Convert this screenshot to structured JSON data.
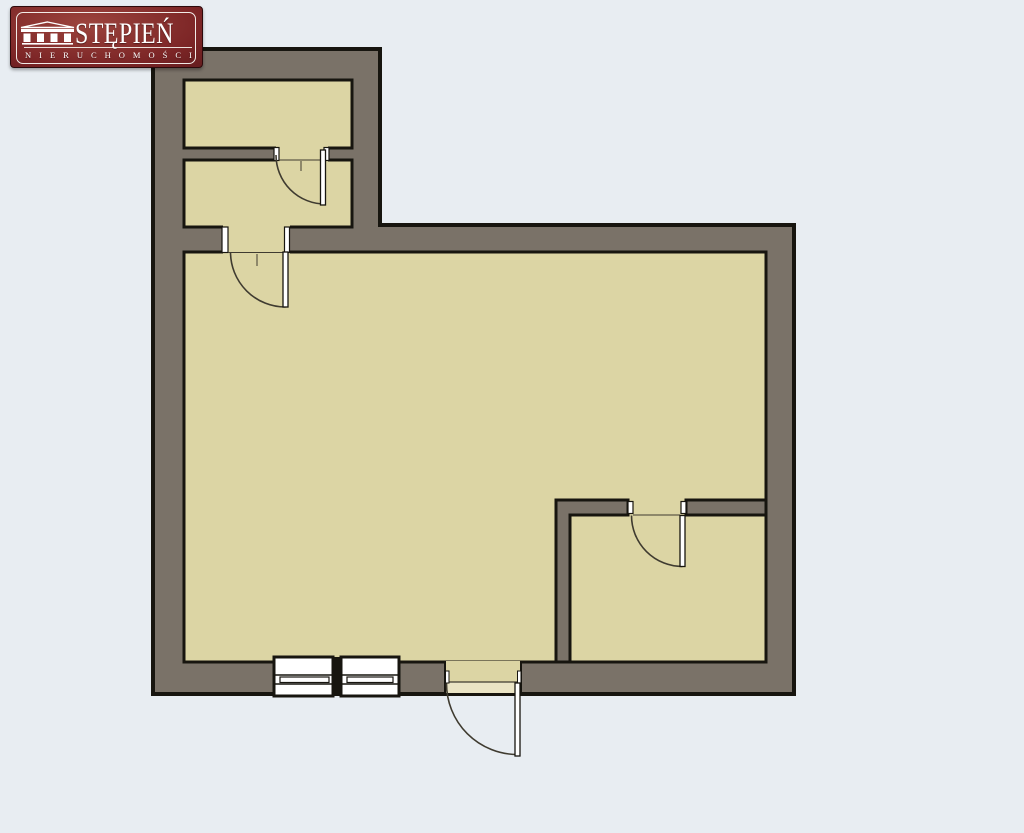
{
  "theme": {
    "background": "#e8edf2",
    "wall": "#7a7268",
    "floor": "#dcd5a4",
    "threshold": "#eae4c5",
    "outline": "#17150f",
    "window": "#ffffff",
    "swing": "#3f3b30",
    "logo_red": "#7c2526",
    "logo_red_light": "#9c443d",
    "logo_red_dark": "#401013",
    "logo_text": "#ffffff",
    "logo_border": "#f8f5f1"
  },
  "logo": {
    "title": "STĘPIEŃ",
    "subtitle": "NIERUCHOMOŚCI",
    "icon": "temple-icon"
  },
  "floorplan": {
    "rooms": [
      "top-small-room-1",
      "top-small-room-2",
      "main-room",
      "bottom-right-room"
    ],
    "door_count": 4,
    "window_count": 2,
    "shapes": [
      {
        "name": "exterior-wall",
        "type": "polygon",
        "points": "153,49 380,49 380,225 794,225 794,694 153,694",
        "fill": "wall",
        "stroke": "outline",
        "sw": 4
      },
      {
        "name": "room-top-1-floor",
        "type": "rect",
        "x": 184,
        "y": 80,
        "w": 168,
        "h": 68,
        "fill": "floor",
        "stroke": "outline",
        "sw": 3
      },
      {
        "name": "room-top-2-floor",
        "type": "rect",
        "x": 184,
        "y": 160,
        "w": 168,
        "h": 67,
        "fill": "floor",
        "stroke": "outline",
        "sw": 3
      },
      {
        "name": "main-room-floor",
        "type": "rect",
        "x": 184,
        "y": 252,
        "w": 582,
        "h": 410,
        "fill": "floor",
        "stroke": "outline",
        "sw": 3
      },
      {
        "name": "door-1-opening",
        "type": "rect",
        "x": 276,
        "y": 146,
        "w": 52,
        "h": 16,
        "fill": "floor"
      },
      {
        "name": "door-2-opening",
        "type": "rect",
        "x": 223,
        "y": 223,
        "w": 67,
        "h": 31,
        "fill": "floor"
      },
      {
        "name": "br-room-wall-left",
        "type": "path",
        "d": "M556,500 L628,500 L628,515 L570,515 L570,662 L556,662 Z",
        "fill": "wall",
        "stroke": "outline",
        "sw": 3
      },
      {
        "name": "br-room-wall-right",
        "type": "rect",
        "x": 686,
        "y": 500,
        "w": 80,
        "h": 15,
        "fill": "wall",
        "stroke": "outline",
        "sw": 3
      },
      {
        "name": "door-1-jamb-left",
        "type": "rect",
        "x": 274,
        "y": 147.5,
        "w": 5,
        "h": 13,
        "fill": "window",
        "stroke": "outline",
        "sw": 1.2
      },
      {
        "name": "door-1-jamb-right",
        "type": "rect",
        "x": 324,
        "y": 147.5,
        "w": 5,
        "h": 13,
        "fill": "window",
        "stroke": "outline",
        "sw": 1.2
      },
      {
        "name": "door-2-jamb-left",
        "type": "rect",
        "x": 222,
        "y": 227,
        "w": 6,
        "h": 25.5,
        "fill": "window",
        "stroke": "outline",
        "sw": 1.2
      },
      {
        "name": "door-2-jamb-right",
        "type": "rect",
        "x": 284.5,
        "y": 227,
        "w": 5,
        "h": 25.5,
        "fill": "window",
        "stroke": "outline",
        "sw": 1.2
      },
      {
        "name": "door-3-jamb-left",
        "type": "rect",
        "x": 628,
        "y": 501.5,
        "w": 5,
        "h": 12,
        "fill": "window",
        "stroke": "outline",
        "sw": 1.2
      },
      {
        "name": "door-3-jamb-right",
        "type": "rect",
        "x": 681,
        "y": 501.5,
        "w": 5,
        "h": 12,
        "fill": "window",
        "stroke": "outline",
        "sw": 1.2
      },
      {
        "name": "entrance-opening-floor",
        "type": "rect",
        "x": 445,
        "y": 661,
        "w": 76,
        "h": 21,
        "fill": "floor"
      },
      {
        "name": "entrance-threshold",
        "type": "rect",
        "x": 445,
        "y": 682,
        "w": 76,
        "h": 11,
        "fill": "threshold"
      },
      {
        "name": "entrance-edge-left",
        "type": "line",
        "x1": 445,
        "y1": 661,
        "x2": 445,
        "y2": 693,
        "stroke": "outline",
        "sw": 2
      },
      {
        "name": "entrance-edge-right",
        "type": "line",
        "x1": 521,
        "y1": 661,
        "x2": 521,
        "y2": 693,
        "stroke": "outline",
        "sw": 2
      },
      {
        "name": "entrance-door-line",
        "type": "line",
        "x1": 447,
        "y1": 682,
        "x2": 517,
        "y2": 682,
        "stroke": "swing",
        "sw": 1.2
      },
      {
        "name": "entrance-jamb-left",
        "type": "rect",
        "x": 445.5,
        "y": 671,
        "w": 3.5,
        "h": 12,
        "fill": "window",
        "stroke": "outline",
        "sw": 1
      },
      {
        "name": "entrance-jamb-right",
        "type": "rect",
        "x": 517.5,
        "y": 671,
        "w": 3.5,
        "h": 12,
        "fill": "window",
        "stroke": "outline",
        "sw": 1
      },
      {
        "name": "window-1-frame",
        "type": "rect",
        "x": 274,
        "y": 657,
        "w": 59,
        "h": 39,
        "fill": "window",
        "stroke": "outline",
        "sw": 3
      },
      {
        "name": "window-2-frame",
        "type": "rect",
        "x": 341,
        "y": 657,
        "w": 58,
        "h": 39,
        "fill": "window",
        "stroke": "outline",
        "sw": 3
      },
      {
        "name": "window-mullion",
        "type": "rect",
        "x": 332.5,
        "y": 657,
        "w": 9,
        "h": 39,
        "fill": "outline"
      },
      {
        "name": "window-1-line-top",
        "type": "line",
        "x1": 275.5,
        "y1": 675,
        "x2": 332,
        "y2": 675,
        "stroke": "outline",
        "sw": 1.4
      },
      {
        "name": "window-1-line-bottom",
        "type": "line",
        "x1": 275.5,
        "y1": 684,
        "x2": 332,
        "y2": 684,
        "stroke": "outline",
        "sw": 1.4
      },
      {
        "name": "window-2-line-top",
        "type": "line",
        "x1": 342,
        "y1": 675,
        "x2": 397.5,
        "y2": 675,
        "stroke": "outline",
        "sw": 1.4
      },
      {
        "name": "window-2-line-bottom",
        "type": "line",
        "x1": 342,
        "y1": 684,
        "x2": 397.5,
        "y2": 684,
        "stroke": "outline",
        "sw": 1.4
      },
      {
        "name": "window-1-pane",
        "type": "rect",
        "x": 280,
        "y": 677,
        "w": 49,
        "h": 5.5,
        "fill": "window",
        "stroke": "outline",
        "sw": 1.2
      },
      {
        "name": "window-2-pane",
        "type": "rect",
        "x": 347,
        "y": 677,
        "w": 46,
        "h": 5.5,
        "fill": "window",
        "stroke": "outline",
        "sw": 1.2
      },
      {
        "name": "door-1-threshold-line",
        "type": "line",
        "x1": 279,
        "y1": 160,
        "x2": 322,
        "y2": 160,
        "stroke": "swing",
        "sw": 1
      },
      {
        "name": "door-1-center-tick",
        "type": "line",
        "x1": 301,
        "y1": 161,
        "x2": 301,
        "y2": 171,
        "stroke": "swing",
        "sw": 1
      },
      {
        "name": "door-1-swing-arc",
        "type": "path",
        "d": "M276,155 A49,49 0 0 0 325,204",
        "fill": "none",
        "stroke": "swing",
        "sw": 1.6
      },
      {
        "name": "door-1-panel",
        "type": "rect",
        "x": 320.5,
        "y": 150,
        "w": 5,
        "h": 55,
        "fill": "window",
        "stroke": "outline",
        "sw": 1.3
      },
      {
        "name": "door-2-threshold-line",
        "type": "line",
        "x1": 228,
        "y1": 252.5,
        "x2": 283,
        "y2": 252.5,
        "stroke": "swing",
        "sw": 1
      },
      {
        "name": "door-2-center-tick",
        "type": "line",
        "x1": 257,
        "y1": 254,
        "x2": 257,
        "y2": 266,
        "stroke": "swing",
        "sw": 1
      },
      {
        "name": "door-2-swing-arc",
        "type": "path",
        "d": "M230.5,252 A55,55 0 0 0 285.5,307",
        "fill": "none",
        "stroke": "swing",
        "sw": 1.6
      },
      {
        "name": "door-2-panel",
        "type": "rect",
        "x": 283,
        "y": 252,
        "w": 5,
        "h": 55,
        "fill": "window",
        "stroke": "outline",
        "sw": 1.3
      },
      {
        "name": "door-3-threshold-line",
        "type": "line",
        "x1": 633,
        "y1": 515,
        "x2": 680,
        "y2": 515,
        "stroke": "swing",
        "sw": 1
      },
      {
        "name": "door-3-swing-arc",
        "type": "path",
        "d": "M631.5,515.5 A51,51 0 0 0 682.5,566.5",
        "fill": "none",
        "stroke": "swing",
        "sw": 1.6
      },
      {
        "name": "door-3-panel",
        "type": "rect",
        "x": 680,
        "y": 515.5,
        "w": 5,
        "h": 51,
        "fill": "window",
        "stroke": "outline",
        "sw": 1.3
      },
      {
        "name": "entrance-swing-arc",
        "type": "path",
        "d": "M446.5,683.5 A71,71 0 0 0 517.5,754.5",
        "fill": "none",
        "stroke": "swing",
        "sw": 1.6
      },
      {
        "name": "entrance-door-panel",
        "type": "rect",
        "x": 515,
        "y": 683,
        "w": 5,
        "h": 73,
        "fill": "window",
        "stroke": "outline",
        "sw": 1.3
      }
    ]
  }
}
